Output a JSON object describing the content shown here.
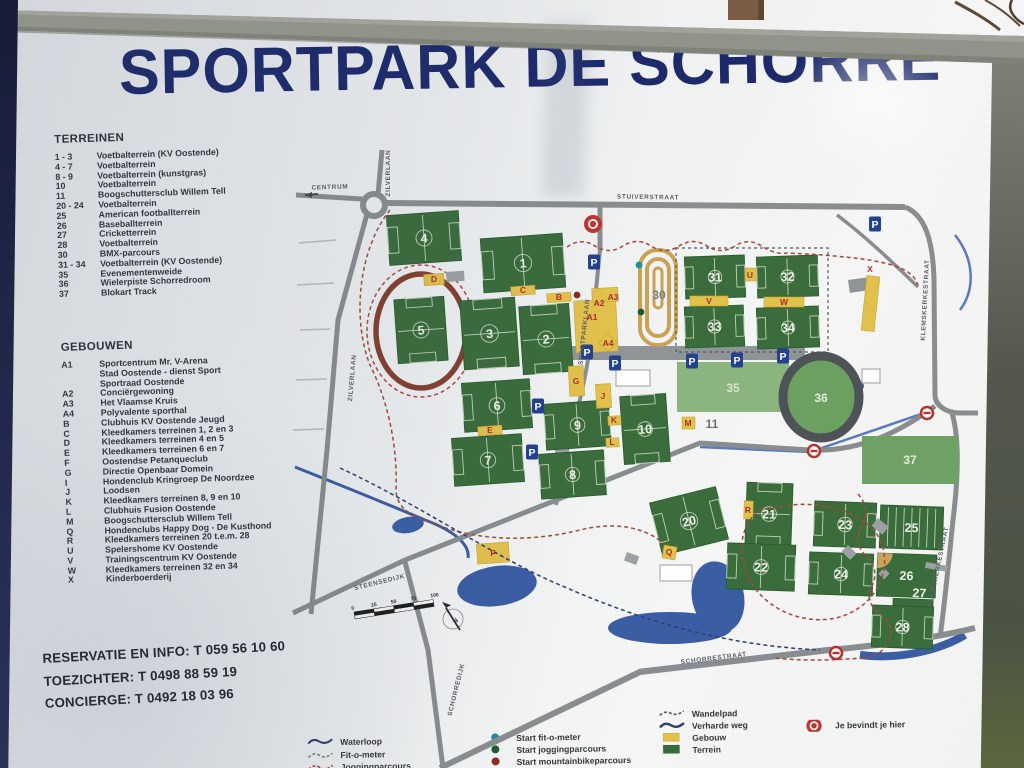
{
  "sign": {
    "title": "SPORTPARK DE SCHORRE",
    "phones": [
      "RESERVATIE EN INFO: T 059 56 10 60",
      "TOEZICHTER: T 0498 88 59 19",
      "CONCIERGE: T 0492 18 03 96"
    ]
  },
  "terreinen": {
    "heading": "TERREINEN",
    "items": [
      {
        "code": "1 - 3",
        "label": "Voetbalterrein (KV Oostende)"
      },
      {
        "code": "4 - 7",
        "label": "Voetbalterrein"
      },
      {
        "code": "8 - 9",
        "label": "Voetbalterrein (kunstgras)"
      },
      {
        "code": "10",
        "label": "Voetbalterrein"
      },
      {
        "code": "11",
        "label": "Boogschuttersclub Willem Tell"
      },
      {
        "code": "20 - 24",
        "label": "Voetbalterrein"
      },
      {
        "code": "25",
        "label": "American footballterrein"
      },
      {
        "code": "26",
        "label": "Baseballterrein"
      },
      {
        "code": "27",
        "label": "Cricketterrein"
      },
      {
        "code": "28",
        "label": "Voetbalterrein"
      },
      {
        "code": "30",
        "label": "BMX-parcours"
      },
      {
        "code": "31 - 34",
        "label": "Voetbalterrein (KV Oostende)"
      },
      {
        "code": "35",
        "label": "Evenementenweide"
      },
      {
        "code": "36",
        "label": "Wielerpiste Schorredroom"
      },
      {
        "code": "37",
        "label": "Blokart Track"
      }
    ]
  },
  "gebouwen": {
    "heading": "GEBOUWEN",
    "items": [
      {
        "code": "A1",
        "lines": [
          "Sportcentrum Mr. V-Arena",
          "Stad Oostende - dienst Sport",
          "Sportraad Oostende"
        ]
      },
      {
        "code": "A2",
        "lines": [
          "Conciërgewoning"
        ]
      },
      {
        "code": "A3",
        "lines": [
          "Het Vlaamse Kruis"
        ]
      },
      {
        "code": "A4",
        "lines": [
          "Polyvalente sporthal"
        ]
      },
      {
        "code": "B",
        "lines": [
          "Clubhuis KV Oostende Jeugd"
        ]
      },
      {
        "code": "C",
        "lines": [
          "Kleedkamers terreinen 1, 2 en 3"
        ]
      },
      {
        "code": "D",
        "lines": [
          "Kleedkamers terreinen 4 en 5"
        ]
      },
      {
        "code": "E",
        "lines": [
          "Kleedkamers terreinen 6 en 7"
        ]
      },
      {
        "code": "F",
        "lines": [
          "Oostendse Petanqueclub"
        ]
      },
      {
        "code": "G",
        "lines": [
          "Directie Openbaar Domein"
        ]
      },
      {
        "code": "I",
        "lines": [
          "Hondenclub Kringroep De Noordzee"
        ]
      },
      {
        "code": "J",
        "lines": [
          "Loodsen"
        ]
      },
      {
        "code": "K",
        "lines": [
          "Kleedkamers terreinen 8, 9 en 10"
        ]
      },
      {
        "code": "L",
        "lines": [
          "Clubhuis Fusion Oostende"
        ]
      },
      {
        "code": "M",
        "lines": [
          "Boogschuttersclub Willem Tell"
        ]
      },
      {
        "code": "Q",
        "lines": [
          "Hondenclubs Happy Dog - De Kusthond"
        ]
      },
      {
        "code": "R",
        "lines": [
          "Kleedkamers terreinen 20 t.e.m. 28"
        ]
      },
      {
        "code": "U",
        "lines": [
          "Spelershome KV Oostende"
        ]
      },
      {
        "code": "V",
        "lines": [
          "Trainingscentrum KV Oostende"
        ]
      },
      {
        "code": "W",
        "lines": [
          "Kleedkamers terreinen 32 en 34"
        ]
      },
      {
        "code": "X",
        "lines": [
          "Kinderboerderij"
        ]
      }
    ]
  },
  "map": {
    "streets": [
      {
        "name": "CENTRUM",
        "x": 330,
        "y": 189,
        "rot": -2
      },
      {
        "name": "ZILVERLAAN",
        "x": 390,
        "y": 173,
        "rot": -90
      },
      {
        "name": "ZILVERLAAN",
        "x": 354,
        "y": 378,
        "rot": -85
      },
      {
        "name": "STUIVERSTRAAT",
        "x": 648,
        "y": 199,
        "rot": 1
      },
      {
        "name": "SPORTPARKLAAN",
        "x": 586,
        "y": 332,
        "rot": -84
      },
      {
        "name": "KLEMSKERKESTRAAT",
        "x": 927,
        "y": 300,
        "rot": -87
      },
      {
        "name": "KLEMSKERKESTRAAT",
        "x": 940,
        "y": 567,
        "rot": -78
      },
      {
        "name": "STEENSEDIJK",
        "x": 380,
        "y": 584,
        "rot": -14
      },
      {
        "name": "SCHORREDIJK",
        "x": 458,
        "y": 690,
        "rot": -76
      },
      {
        "name": "SCHORRESTRAAT",
        "x": 714,
        "y": 660,
        "rot": -7
      }
    ],
    "fields": [
      {
        "n": "4",
        "x": 388,
        "y": 213,
        "w": 72,
        "h": 50,
        "r": -4,
        "t": "soccer"
      },
      {
        "n": "1",
        "x": 482,
        "y": 236,
        "w": 82,
        "h": 54,
        "r": -4,
        "t": "soccer"
      },
      {
        "n": "5",
        "x": 396,
        "y": 298,
        "w": 50,
        "h": 64,
        "r": -4,
        "t": "soccer"
      },
      {
        "n": "3",
        "x": 462,
        "y": 299,
        "w": 55,
        "h": 69,
        "r": -4,
        "t": "soccer"
      },
      {
        "n": "2",
        "x": 521,
        "y": 305,
        "w": 50,
        "h": 68,
        "r": -4,
        "t": "soccer"
      },
      {
        "n": "6",
        "x": 463,
        "y": 381,
        "w": 68,
        "h": 49,
        "r": -4,
        "t": "soccer"
      },
      {
        "n": "7",
        "x": 453,
        "y": 436,
        "w": 70,
        "h": 48,
        "r": -4,
        "t": "soccer"
      },
      {
        "n": "9",
        "x": 545,
        "y": 402,
        "w": 65,
        "h": 46,
        "r": -4,
        "t": "soccer"
      },
      {
        "n": "8",
        "x": 540,
        "y": 452,
        "w": 65,
        "h": 45,
        "r": -4,
        "t": "soccer"
      },
      {
        "n": "10",
        "x": 622,
        "y": 395,
        "w": 46,
        "h": 68,
        "r": -4,
        "t": "soccer"
      },
      {
        "n": "31",
        "x": 685,
        "y": 256,
        "w": 60,
        "h": 42,
        "r": -2,
        "t": "soccer"
      },
      {
        "n": "32",
        "x": 757,
        "y": 256,
        "w": 61,
        "h": 41,
        "r": -2,
        "t": "soccer"
      },
      {
        "n": "33",
        "x": 685,
        "y": 306,
        "w": 59,
        "h": 41,
        "r": -2,
        "t": "soccer"
      },
      {
        "n": "34",
        "x": 757,
        "y": 307,
        "w": 62,
        "h": 41,
        "r": -2,
        "t": "soccer"
      },
      {
        "n": "20",
        "x": 655,
        "y": 494,
        "w": 68,
        "h": 54,
        "r": -14,
        "t": "soccer"
      },
      {
        "n": "21",
        "x": 746,
        "y": 483,
        "w": 46,
        "h": 62,
        "r": 2,
        "t": "soccer"
      },
      {
        "n": "22",
        "x": 727,
        "y": 544,
        "w": 68,
        "h": 46,
        "r": 2,
        "t": "soccer"
      },
      {
        "n": "23",
        "x": 814,
        "y": 502,
        "w": 62,
        "h": 45,
        "r": 2,
        "t": "soccer"
      },
      {
        "n": "24",
        "x": 809,
        "y": 553,
        "w": 64,
        "h": 42,
        "r": 2,
        "t": "soccer"
      },
      {
        "n": "25",
        "x": 880,
        "y": 506,
        "w": 63,
        "h": 43,
        "r": 2,
        "t": "american"
      },
      {
        "n": "26",
        "x": 877,
        "y": 554,
        "w": 59,
        "h": 43,
        "r": 2,
        "t": "baseball"
      },
      {
        "n": "27",
        "x": 893,
        "y": 599,
        "w": 40,
        "h": 9,
        "r": 2,
        "t": "strip"
      },
      {
        "n": "28",
        "x": 872,
        "y": 606,
        "w": 61,
        "h": 42,
        "r": 2,
        "t": "soccer"
      }
    ],
    "areas": [
      {
        "n": "35",
        "x": 677,
        "y": 362,
        "w": 112,
        "h": 50,
        "fill": "#8cb47e"
      },
      {
        "n": "37",
        "x": 862,
        "y": 436,
        "w": 96,
        "h": 48,
        "fill": "#70a164"
      }
    ],
    "velodrome": {
      "n": "36",
      "cx": 821,
      "cy": 397,
      "rx": 38,
      "ry": 41
    },
    "buildings": [
      {
        "x": 575,
        "y": 300,
        "w": 42,
        "h": 52,
        "r": -3
      },
      {
        "x": 592,
        "y": 288,
        "w": 26,
        "h": 14,
        "r": -3
      },
      {
        "x": 601,
        "y": 336,
        "w": 13,
        "h": 13,
        "r": 40
      },
      {
        "x": 547,
        "y": 293,
        "w": 24,
        "h": 9,
        "r": -4
      },
      {
        "x": 511,
        "y": 286,
        "w": 24,
        "h": 9,
        "r": -4
      },
      {
        "x": 424,
        "y": 274,
        "w": 20,
        "h": 11,
        "r": -4
      },
      {
        "x": 478,
        "y": 426,
        "w": 24,
        "h": 9,
        "r": -4
      },
      {
        "x": 477,
        "y": 543,
        "w": 32,
        "h": 20,
        "r": -4
      },
      {
        "x": 569,
        "y": 366,
        "w": 15,
        "h": 30,
        "r": -3
      },
      {
        "x": 596,
        "y": 384,
        "w": 15,
        "h": 24,
        "r": -3
      },
      {
        "x": 608,
        "y": 416,
        "w": 13,
        "h": 9,
        "r": -3
      },
      {
        "x": 606,
        "y": 438,
        "w": 13,
        "h": 9,
        "r": -3
      },
      {
        "x": 682,
        "y": 417,
        "w": 13,
        "h": 12,
        "r": 0
      },
      {
        "x": 663,
        "y": 546,
        "w": 13,
        "h": 13,
        "r": 10
      },
      {
        "x": 744,
        "y": 501,
        "w": 9,
        "h": 18,
        "r": 2
      },
      {
        "x": 745,
        "y": 268,
        "w": 11,
        "h": 13,
        "r": 0
      },
      {
        "x": 690,
        "y": 296,
        "w": 38,
        "h": 10,
        "r": 0
      },
      {
        "x": 764,
        "y": 297,
        "w": 40,
        "h": 10,
        "r": 0
      },
      {
        "x": 864,
        "y": 276,
        "w": 13,
        "h": 55,
        "r": 6
      }
    ],
    "letters": [
      {
        "ch": "A1",
        "x": 592,
        "y": 320
      },
      {
        "ch": "A2",
        "x": 599,
        "y": 306
      },
      {
        "ch": "A3",
        "x": 613,
        "y": 300
      },
      {
        "ch": "A4",
        "x": 608,
        "y": 346
      },
      {
        "ch": "B",
        "x": 559,
        "y": 300
      },
      {
        "ch": "C",
        "x": 523,
        "y": 293
      },
      {
        "ch": "D",
        "x": 434,
        "y": 282
      },
      {
        "ch": "E",
        "x": 490,
        "y": 433
      },
      {
        "ch": "F",
        "x": 493,
        "y": 556
      },
      {
        "ch": "G",
        "x": 576,
        "y": 384
      },
      {
        "ch": "J",
        "x": 603,
        "y": 399
      },
      {
        "ch": "K",
        "x": 614,
        "y": 423
      },
      {
        "ch": "L",
        "x": 612,
        "y": 445
      },
      {
        "ch": "M",
        "x": 688,
        "y": 426
      },
      {
        "ch": "Q",
        "x": 669,
        "y": 555
      },
      {
        "ch": "R",
        "x": 748,
        "y": 513
      },
      {
        "ch": "U",
        "x": 750,
        "y": 278
      },
      {
        "ch": "V",
        "x": 709,
        "y": 304
      },
      {
        "ch": "W",
        "x": 784,
        "y": 305
      },
      {
        "ch": "X",
        "x": 870,
        "y": 272
      }
    ],
    "gray_labels": [
      {
        "t": "30",
        "x": 659,
        "y": 299,
        "f": "#787d82"
      },
      {
        "t": "11",
        "x": 712,
        "y": 428,
        "f": "#6f747a"
      },
      {
        "t": "35",
        "x": 733,
        "y": 392,
        "f": "#dcdfd4"
      },
      {
        "t": "36",
        "x": 821,
        "y": 402,
        "f": "#e6e9df"
      },
      {
        "t": "37",
        "x": 910,
        "y": 464,
        "f": "#e6e9df"
      }
    ],
    "parking": [
      [
        594,
        262
      ],
      [
        875,
        224
      ],
      [
        587,
        352
      ],
      [
        615,
        363
      ],
      [
        692,
        361
      ],
      [
        737,
        360
      ],
      [
        783,
        356
      ],
      [
        538,
        406
      ],
      [
        532,
        452
      ]
    ],
    "no_entry": [
      [
        814,
        451
      ],
      [
        927,
        413
      ],
      [
        836,
        653
      ]
    ],
    "you_are_here": [
      593,
      224
    ],
    "start_dots": [
      {
        "c": "#1f8f99",
        "x": 639,
        "y": 265
      },
      {
        "c": "#1d5a33",
        "x": 641,
        "y": 312
      },
      {
        "c": "#8e2a25",
        "x": 577,
        "y": 295
      }
    ],
    "scale_ticks": [
      "0",
      "25",
      "50",
      "75",
      "100"
    ],
    "compass_letter": "N",
    "parking_letter": "P"
  },
  "legend": {
    "items": [
      {
        "symbol": "waterloop",
        "label": "Waterloop",
        "x": 300,
        "y": 739
      },
      {
        "symbol": "fitometer",
        "label": "Fit-o-meter",
        "x": 300,
        "y": 752
      },
      {
        "symbol": "jogging",
        "label": "Joggingparcours",
        "x": 300,
        "y": 764
      },
      {
        "symbol": "dot-teal",
        "label": "Start fit-o-meter",
        "x": 476,
        "y": 738
      },
      {
        "symbol": "dot-green",
        "label": "Start joggingparcours",
        "x": 476,
        "y": 750
      },
      {
        "symbol": "dot-red",
        "label": "Start mountainbikeparcours",
        "x": 476,
        "y": 762
      },
      {
        "symbol": "wandelpad",
        "label": "Wandelpad",
        "x": 652,
        "y": 717
      },
      {
        "symbol": "verhardeweg",
        "label": "Verharde weg",
        "x": 652,
        "y": 729
      },
      {
        "symbol": "gebouw",
        "label": "Gebouw",
        "x": 652,
        "y": 741
      },
      {
        "symbol": "terrein",
        "label": "Terrein",
        "x": 652,
        "y": 753
      },
      {
        "symbol": "youarehere",
        "label": "Je bevindt je hier",
        "x": 795,
        "y": 731
      }
    ]
  },
  "colors": {
    "title_navy": "#1c2a6b",
    "pitch_green": "#3a6c3c",
    "building_yellow": "#e2c04c",
    "letter_red": "#a8302b",
    "road_gray": "#898d90",
    "water_blue": "#3a5da4",
    "track_brown": "#83402f",
    "bmx_tan": "#c9a254",
    "parking_blue": "#23418e",
    "sign_red": "#b5352e"
  }
}
